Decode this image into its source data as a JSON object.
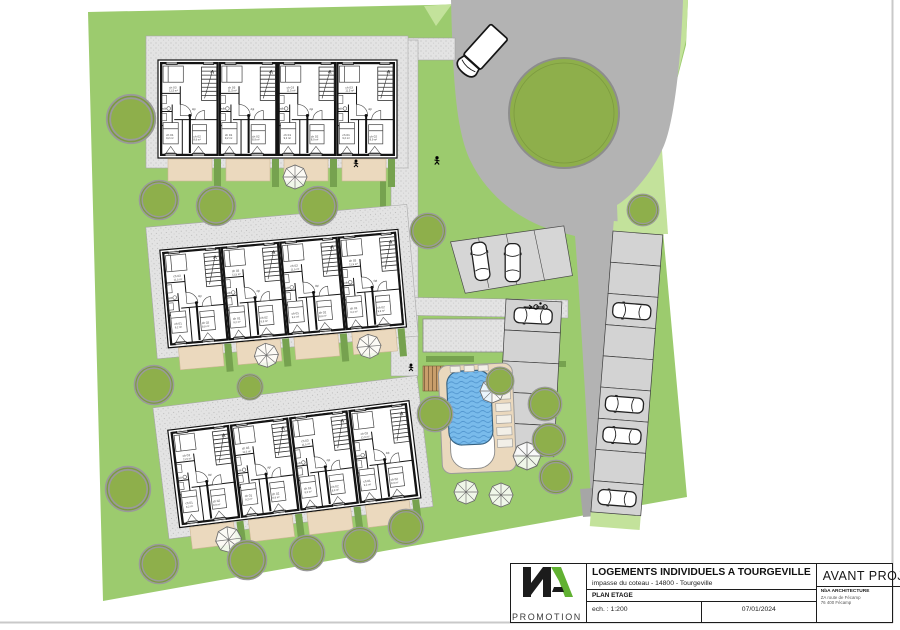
{
  "title_block": {
    "project_title": "LOGEMENTS INDIVIDUELS A TOURGEVILLE",
    "address": "impasse du coteau  - 14800 - Tourgeville",
    "drawing_name": "PLAN ETAGE",
    "scale_label": "ech. : 1:200",
    "date": "07/01/2024",
    "status": "AVANT PROJET",
    "promoter_label": "PROMOTION",
    "architect_name": "NbA ARCHITECTURE",
    "architect_addr1": "ZA route de Fécamp",
    "architect_addr2": "76 400 Fécamp",
    "sheet_number": "9",
    "sheet_suffix": "bis"
  },
  "unit_labels": {
    "room1": "ch 03",
    "room1_area": "11,5 m²",
    "bath": "sdb",
    "bath_area": "4,1 m²",
    "hall": "dgt",
    "room2": "ch 01",
    "room2_area": "9,2 m²",
    "room3": "ch 02",
    "room3_area": "8,9 m²"
  },
  "site": {
    "building_rows": 3,
    "units_per_row": 4,
    "parking_right_stalls": 9,
    "parked_cars_total": 7
  },
  "colors": {
    "lawn": "#9CCB6E",
    "lawn_light": "#C3E29B",
    "tree": "#8EAF4B",
    "road": "#B3B3B3",
    "stall": "#D3D3D3",
    "terrace": "#EBD9BE",
    "pool_water": "#79BBEB",
    "deck": "#EAD8BD",
    "accent_green": "#61B132"
  }
}
